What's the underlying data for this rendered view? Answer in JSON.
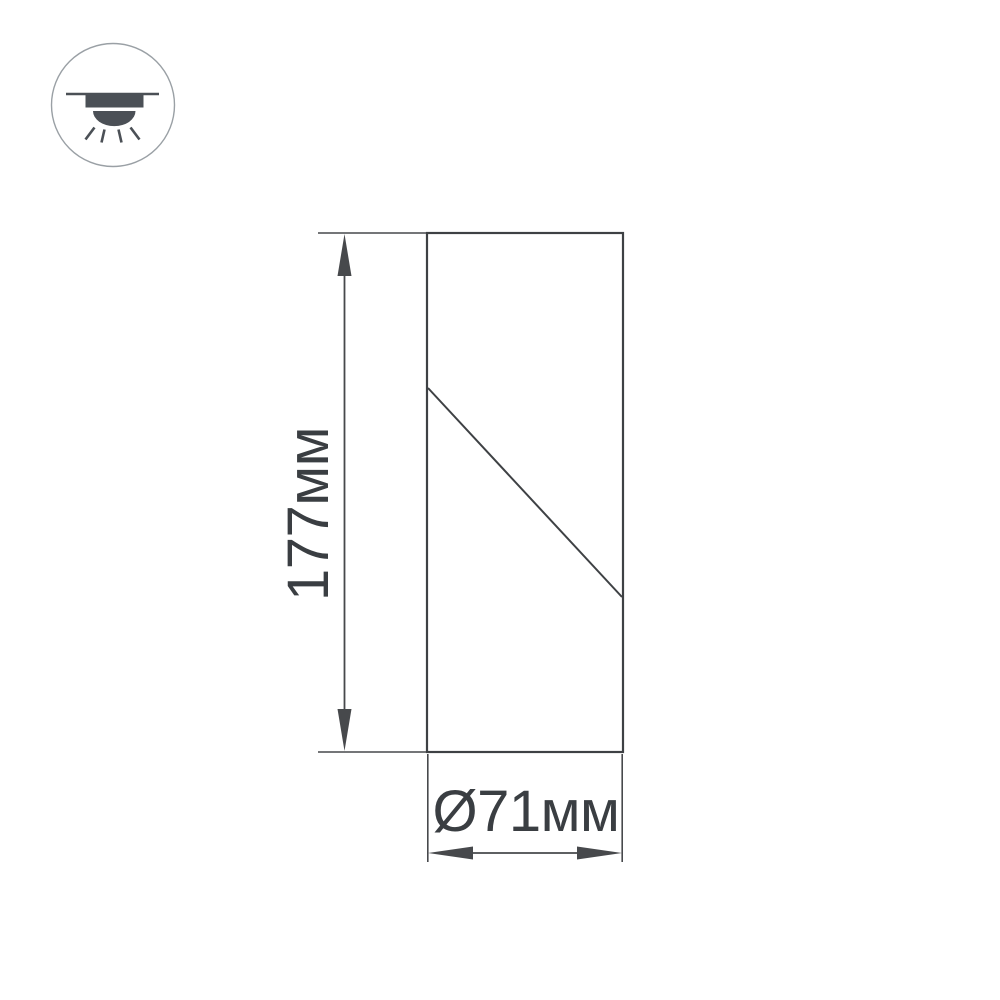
{
  "page": {
    "background": "#ffffff"
  },
  "colors": {
    "outline_line": "#3e4144",
    "dimension_line": "#47494c",
    "label_text": "#3a3e42",
    "icon_glyph": "#4b5056",
    "icon_circle_stroke": "#9aa0a5"
  },
  "icon": {
    "name": "ceiling-light-icon",
    "meaning": "surface ceiling-mounted downlight symbol"
  },
  "dimensions": {
    "height": {
      "label": "177мм",
      "value": 177,
      "unit": "мм"
    },
    "diameter": {
      "label": "Ø71мм",
      "value": 71,
      "unit": "мм",
      "symbol": "Ø"
    }
  }
}
